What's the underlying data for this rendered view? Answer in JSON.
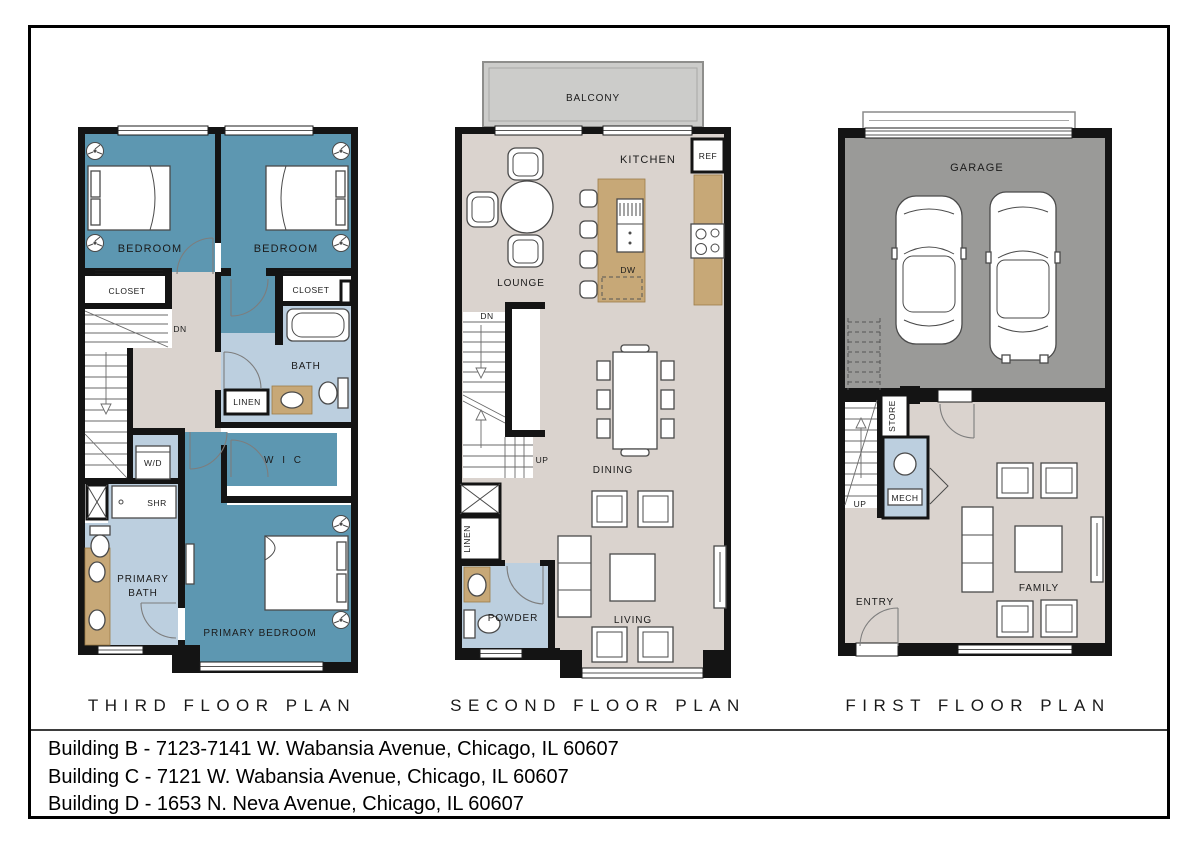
{
  "colors": {
    "teal": "#5D97B1",
    "blue": "#BCCFDF",
    "taupe": "#DAD3CE",
    "garage": "#9A9A98",
    "balcony": "#CCCCCA",
    "tan": "#C7A877",
    "wall": "#141414"
  },
  "titles": {
    "third": "THIRD FLOOR PLAN",
    "second": "SECOND FLOOR PLAN",
    "first": "FIRST FLOOR PLAN"
  },
  "footer": {
    "lines": [
      "Building B - 7123-7141 W. Wabansia Avenue, Chicago, IL 60607",
      "Building C - 7121 W. Wabansia Avenue, Chicago, IL 60607",
      "Building D - 1653 N. Neva Avenue, Chicago, IL 60607"
    ]
  },
  "third": {
    "bedroom1": "BEDROOM",
    "bedroom2": "BEDROOM",
    "closet1": "CLOSET",
    "closet2": "CLOSET",
    "dn": "DN",
    "bath": "BATH",
    "linen": "LINEN",
    "wd": "W/D",
    "wic": "W I C",
    "shr": "SHR",
    "primary_bath_line1": "PRIMARY",
    "primary_bath_line2": "BATH",
    "primary_bedroom": "PRIMARY BEDROOM"
  },
  "second": {
    "balcony": "BALCONY",
    "kitchen": "KITCHEN",
    "ref": "REF",
    "lounge": "LOUNGE",
    "dw": "DW",
    "dn": "DN",
    "up": "UP",
    "dining": "DINING",
    "linen": "LINEN",
    "powder": "POWDER",
    "living": "LIVING"
  },
  "first": {
    "garage": "GARAGE",
    "store": "STORE",
    "mech": "MECH",
    "up": "UP",
    "entry": "ENTRY",
    "family": "FAMILY"
  }
}
